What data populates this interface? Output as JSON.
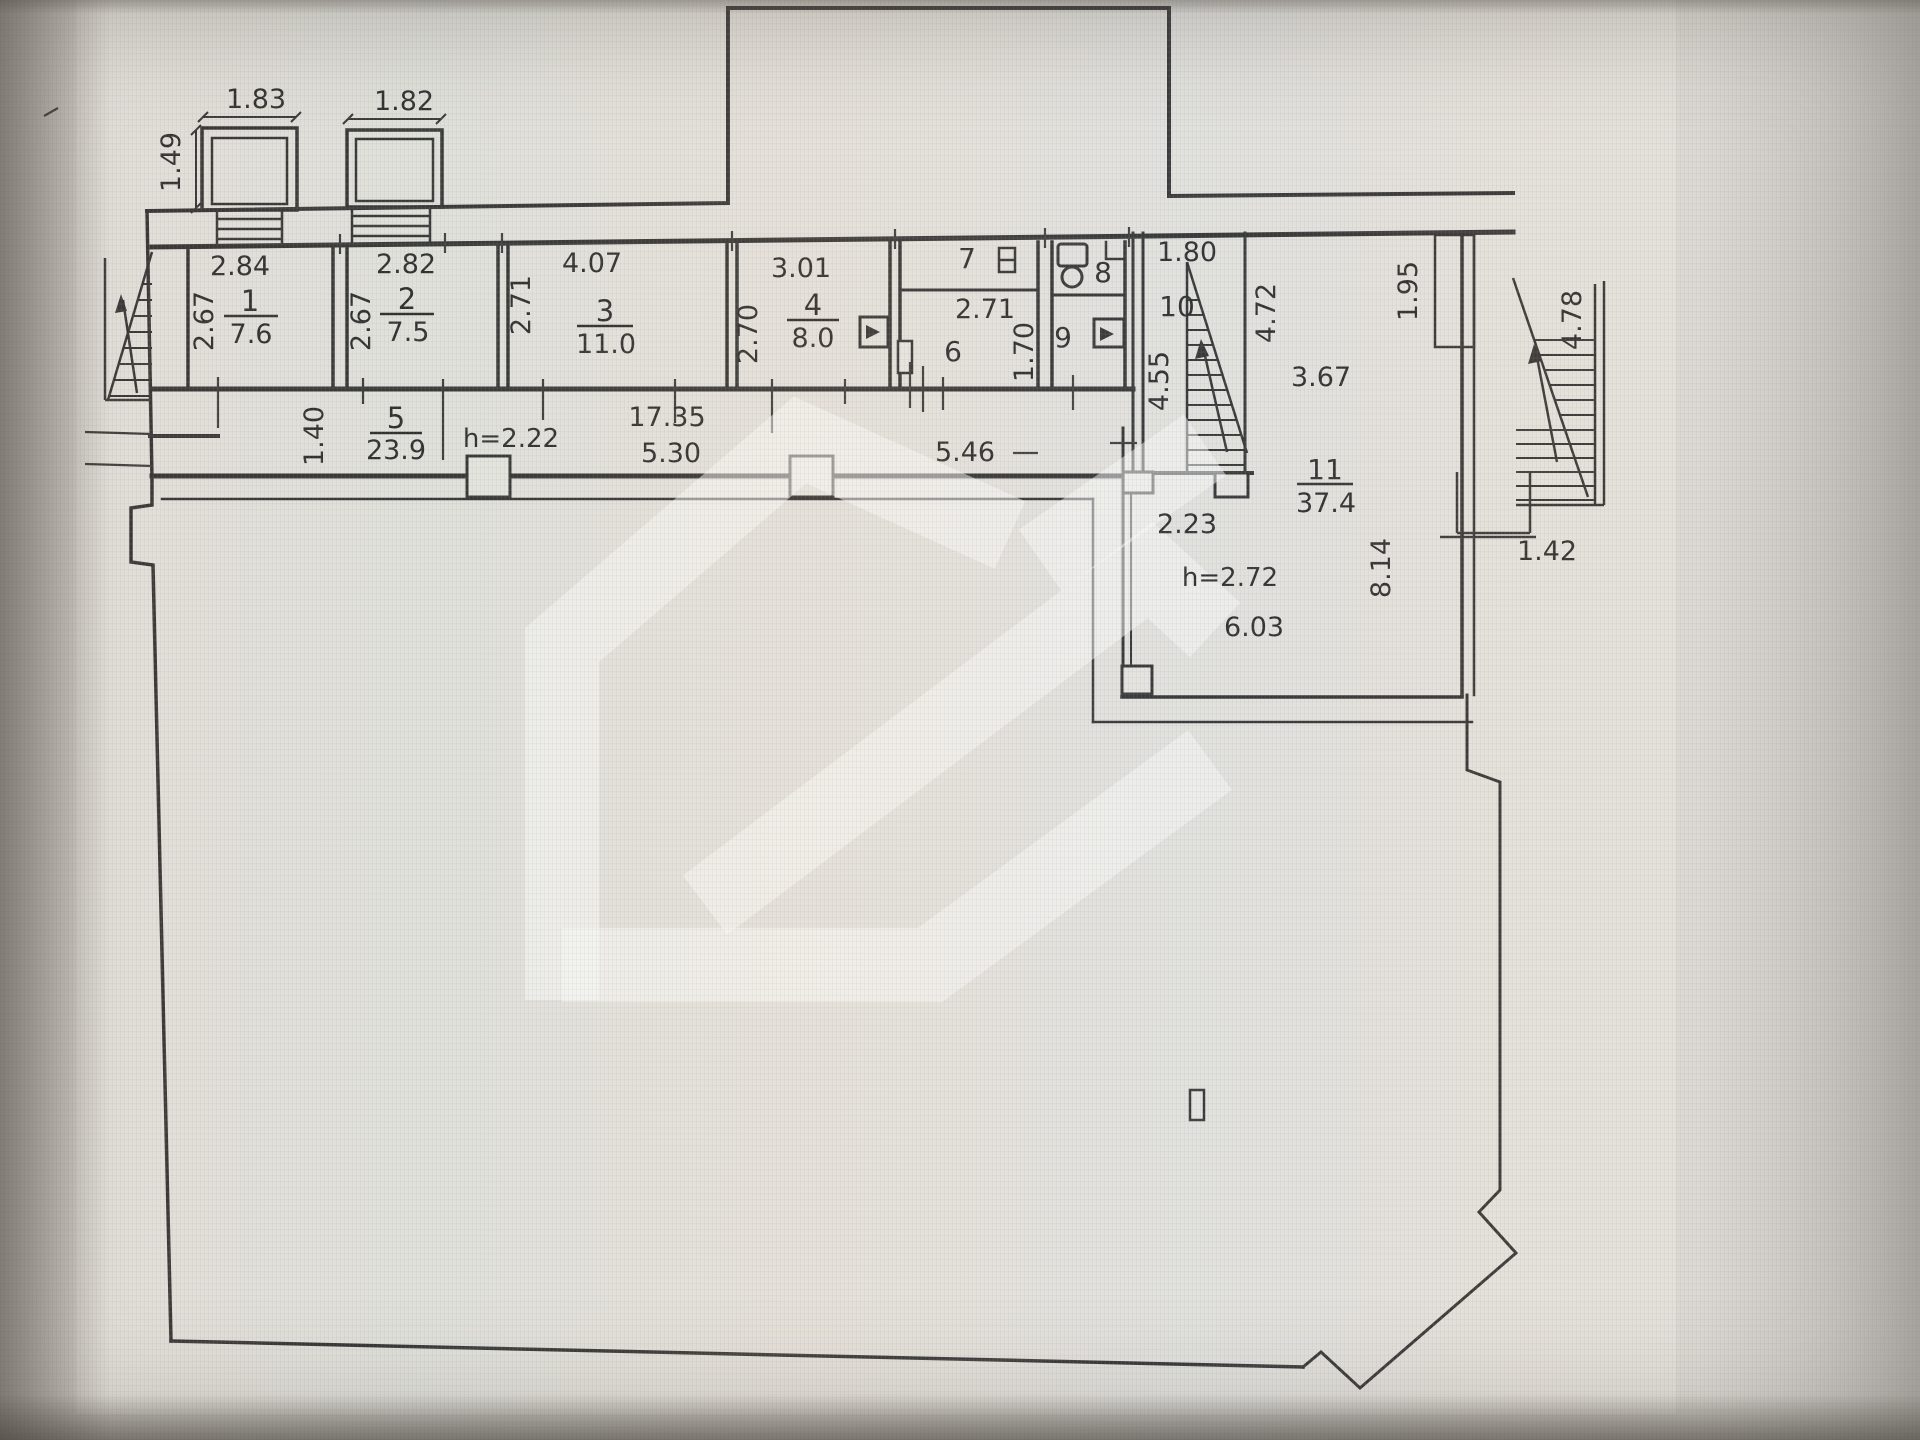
{
  "colors": {
    "paper": "#edebe6",
    "line": "#262626",
    "watermark": "rgba(255,255,255,0.5)"
  },
  "icons": {
    "left_entrance_stair": "stair-hatch-triangle-with-up-arrow",
    "room10_stair": "stair-hatch-triangle-with-up-arrow",
    "right_outside_stair": "stair-hatch-triangle-with-up-arrow",
    "room7_fixture": "small-radiator-icon",
    "room8_toilet": "toilet-tank-and-bowl-icon",
    "room4_vent": "vent-duct-square-with-triangle",
    "room9_vent": "vent-duct-square-with-triangle",
    "room6_door": "door-jamb-icon",
    "watermark_logo": "house-shaped-agency-watermark"
  },
  "plan": {
    "balconies": {
      "b1_width": "1.83",
      "b2_width": "1.82",
      "depth": "1.49"
    },
    "rooms": {
      "r1": {
        "num": "1",
        "area": "7.6"
      },
      "r2": {
        "num": "2",
        "area": "7.5"
      },
      "r3": {
        "num": "3",
        "area": "11.0"
      },
      "r4": {
        "num": "4",
        "area": "8.0"
      },
      "r5": {
        "num": "5",
        "area": "23.9"
      },
      "r6": {
        "num": "6"
      },
      "r7": {
        "num": "7"
      },
      "r8": {
        "num": "8"
      },
      "r9": {
        "num": "9"
      },
      "r10": {
        "num": "10"
      },
      "r11": {
        "num": "11",
        "area": "37.4"
      }
    },
    "dims": {
      "r1_w": "2.84",
      "r1_d": "2.67",
      "r2_w": "2.82",
      "r2_d": "2.67",
      "r3_w": "4.07",
      "r3_d": "2.71",
      "r4_w": "3.01",
      "r4_d": "2.70",
      "r5_d": "1.40",
      "r5_h": "h=2.22",
      "corr_total": "17.35",
      "corr_part1": "5.30",
      "corr_part2": "5.46",
      "r6_w": "2.71",
      "r6_d": "1.70",
      "r10_w": "1.80",
      "r10_d": "4.55",
      "r11_w1": "4.72",
      "r11_w2": "3.67",
      "r11_w3": "6.03",
      "r11_d": "8.14",
      "r11_h": "h=2.72",
      "r11_pass": "2.23",
      "niche": "1.95",
      "stair_right": "4.78",
      "stair_landing": "1.42"
    }
  }
}
